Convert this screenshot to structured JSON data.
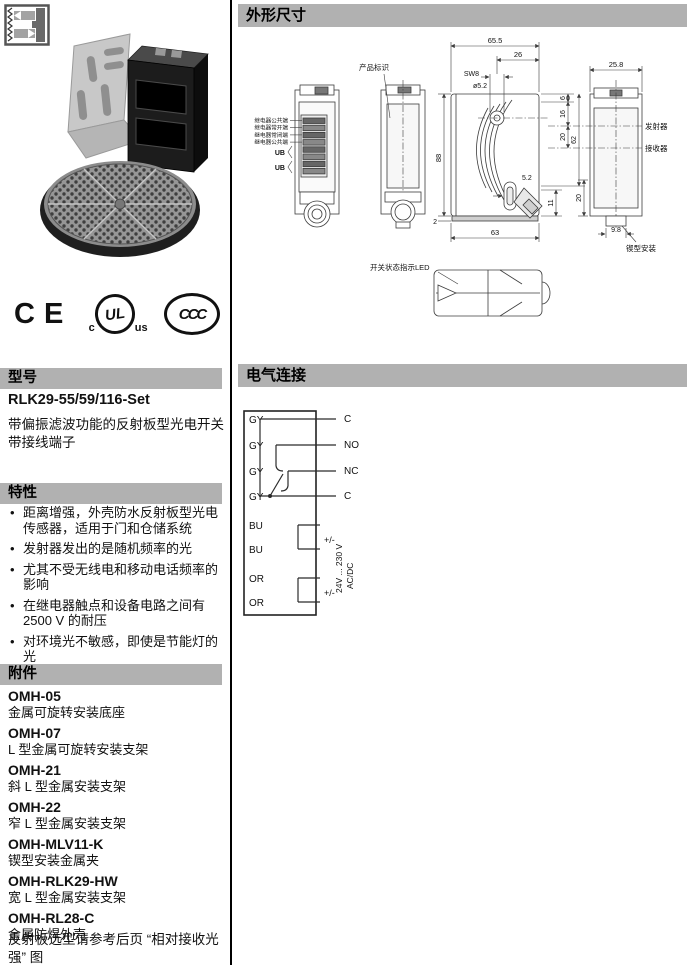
{
  "sections": {
    "model": "型号",
    "features": "特性",
    "accessories": "附件",
    "dimensions": "外形尺寸",
    "wiring": "电气连接"
  },
  "certifications": {
    "ce": "CE",
    "ul_c": "c",
    "ul": "UL",
    "ul_us": "us",
    "ccc": "CCC"
  },
  "model": {
    "name": "RLK29-55/59/116-Set",
    "desc_line1": "带偏振滤波功能的反射板型光电开关",
    "desc_line2": "带接线端子"
  },
  "features": {
    "items": [
      "距离增强，外壳防水反射板型光电传感器，适用于门和仓储系统",
      "发射器发出的是随机频率的光",
      "尤其不受无线电和移动电话频率的影响",
      "在继电器触点和设备电路之间有2500 V 的耐压",
      "对环境光不敏感，即使是节能灯的光",
      "产品包装中包括反射板和安装支架"
    ]
  },
  "accessories": {
    "items": [
      {
        "code": "OMH-05",
        "desc": "金属可旋转安装底座"
      },
      {
        "code": "OMH-07",
        "desc": "L 型金属可旋转安装支架"
      },
      {
        "code": "OMH-21",
        "desc": "斜 L 型金属安装支架"
      },
      {
        "code": "OMH-22",
        "desc": "窄 L 型金属安装支架"
      },
      {
        "code": "OMH-MLV11-K",
        "desc": "锲型安装金属夹"
      },
      {
        "code": "OMH-RLK29-HW",
        "desc": "宽 L 型金属安装支架"
      },
      {
        "code": "OMH-RL28-C",
        "desc": "金属防焊外壳"
      }
    ],
    "note": "反射板选型请参考后页 “相对接收光强” 图"
  },
  "dimensions": {
    "labels": {
      "product_id": "产品标识",
      "emitter": "发射器",
      "receiver": "接收器",
      "wedge_mount": "锲型安装",
      "led": "开关状态指示LED",
      "relay_com1": "继电器公共端",
      "relay_no": "继电器常开端",
      "relay_nc": "继电器常闭端",
      "relay_com2": "继电器公共端",
      "ub1": "UB",
      "ub2": "UB"
    },
    "values": {
      "w_655": "65.5",
      "w_26": "26",
      "sw8": "SW8",
      "dia_52": "ø5.2",
      "w_258": "25.8",
      "h_6": "6",
      "h_16": "16",
      "h_20": "20",
      "h_62": "62",
      "h_88": "88",
      "slot_52": "5.2",
      "h_11": "11",
      "h_2": "2",
      "w_63": "63",
      "w_98": "9.8",
      "h_20b": "20"
    }
  },
  "wiring": {
    "terminals": [
      "GY",
      "GY",
      "GY",
      "GY",
      "BU",
      "BU",
      "OR",
      "OR"
    ],
    "outputs": [
      "C",
      "NO",
      "NC",
      "C"
    ],
    "supply_relay_1": "+/-",
    "supply_relay_2": "+/-",
    "voltage_range": "24V ... 230 V",
    "voltage_type": "AC/DC"
  }
}
